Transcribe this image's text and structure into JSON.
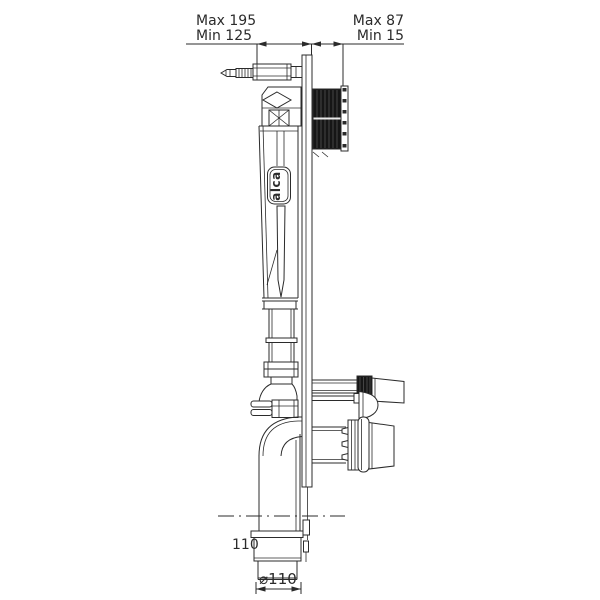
{
  "drawing": {
    "labels": {
      "dim_left_max": "Max 195",
      "dim_left_min": "Min 125",
      "dim_right_max": "Max 87",
      "dim_right_min": "Min 15",
      "offset_label": "110",
      "diameter_label": "⌀110",
      "brand": "alca"
    },
    "colors": {
      "line": "#2b2b2b",
      "background": "#ffffff",
      "thread_block": "#161616"
    }
  }
}
